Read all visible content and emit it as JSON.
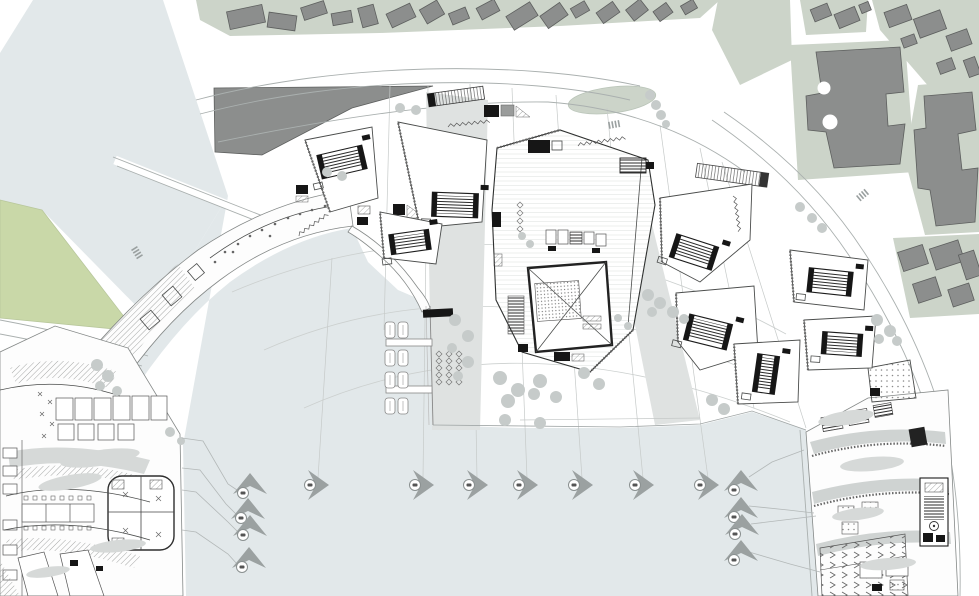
{
  "meta": {
    "drawing_type": "architectural-masterplan-site-plan",
    "canvas": {
      "w": 979,
      "h": 596
    }
  },
  "palette": {
    "water": "#e2e8ea",
    "park": "#c9d8a8",
    "block_green": "#ccd4c9",
    "bldg_gray": "#8c8e8d",
    "bldg_stroke": "#5d5f5e",
    "line": "#aab0af",
    "band": "#cfd3d2",
    "wash": "#dfe2e1",
    "tree": "#c6cbca",
    "dark": "#161616",
    "marker": "#9ba1a1"
  },
  "plan": {
    "markers": {
      "up": [
        {
          "x": 250,
          "y": 484
        },
        {
          "x": 248,
          "y": 509
        },
        {
          "x": 250,
          "y": 526
        },
        {
          "x": 249,
          "y": 558
        },
        {
          "x": 741,
          "y": 481
        },
        {
          "x": 741,
          "y": 508
        },
        {
          "x": 742,
          "y": 525
        },
        {
          "x": 741,
          "y": 551
        }
      ],
      "right": [
        {
          "x": 318,
          "y": 485
        },
        {
          "x": 423,
          "y": 485
        },
        {
          "x": 477,
          "y": 485
        },
        {
          "x": 527,
          "y": 485
        },
        {
          "x": 582,
          "y": 485
        },
        {
          "x": 643,
          "y": 485
        },
        {
          "x": 708,
          "y": 485
        }
      ]
    },
    "leader_lines": [
      [
        [
          182,
          438
        ],
        [
          203,
          441
        ],
        [
          228,
          484
        ],
        [
          237,
          490
        ]
      ],
      [
        [
          182,
          468
        ],
        [
          200,
          470
        ],
        [
          226,
          504
        ],
        [
          236,
          514
        ]
      ],
      [
        [
          182,
          490
        ],
        [
          196,
          492
        ],
        [
          228,
          522
        ],
        [
          238,
          532
        ]
      ],
      [
        [
          182,
          530
        ],
        [
          196,
          532
        ],
        [
          228,
          554
        ],
        [
          237,
          564
        ]
      ],
      [
        [
          749,
          477
        ],
        [
          772,
          462
        ],
        [
          804,
          450
        ]
      ],
      [
        [
          749,
          506
        ],
        [
          788,
          510
        ],
        [
          814,
          513
        ]
      ],
      [
        [
          751,
          524
        ],
        [
          792,
          519
        ],
        [
          816,
          516
        ]
      ],
      [
        [
          749,
          552
        ],
        [
          790,
          564
        ],
        [
          820,
          572
        ]
      ]
    ],
    "radial_lines": [
      [
        332,
        258,
        318,
        478
      ],
      [
        390,
        86,
        384,
        330
      ],
      [
        428,
        86,
        423,
        478
      ],
      [
        470,
        84,
        477,
        478
      ],
      [
        512,
        88,
        527,
        478
      ],
      [
        556,
        95,
        582,
        478
      ],
      [
        607,
        108,
        643,
        478
      ],
      [
        660,
        125,
        708,
        478
      ],
      [
        700,
        148,
        754,
        408
      ],
      [
        722,
        162,
        806,
        428
      ]
    ],
    "contour_curves": [
      "M 232,292 Q 500,178 786,334",
      "M 264,350 Q 505,244 796,394",
      "M 304,408 Q 520,312 790,422"
    ],
    "trees": [
      [
        400,
        108,
        5
      ],
      [
        416,
        110,
        5
      ],
      [
        650,
        95,
        5
      ],
      [
        656,
        105,
        5
      ],
      [
        661,
        115,
        5
      ],
      [
        666,
        124,
        4
      ],
      [
        327,
        172,
        5
      ],
      [
        342,
        176,
        5
      ],
      [
        800,
        207,
        5
      ],
      [
        812,
        218,
        5
      ],
      [
        822,
        228,
        5
      ],
      [
        648,
        295,
        6
      ],
      [
        660,
        303,
        6
      ],
      [
        673,
        312,
        6
      ],
      [
        684,
        319,
        5
      ],
      [
        652,
        312,
        5
      ],
      [
        712,
        400,
        6
      ],
      [
        724,
        409,
        6
      ],
      [
        877,
        320,
        6
      ],
      [
        890,
        331,
        6
      ],
      [
        897,
        341,
        5
      ],
      [
        879,
        339,
        5
      ],
      [
        500,
        378,
        7
      ],
      [
        518,
        390,
        7
      ],
      [
        508,
        401,
        7
      ],
      [
        540,
        381,
        7
      ],
      [
        534,
        394,
        6
      ],
      [
        556,
        397,
        6
      ],
      [
        584,
        373,
        6
      ],
      [
        599,
        384,
        6
      ],
      [
        505,
        420,
        6
      ],
      [
        540,
        423,
        6
      ],
      [
        455,
        320,
        6
      ],
      [
        468,
        336,
        6
      ],
      [
        452,
        348,
        5
      ],
      [
        468,
        362,
        6
      ],
      [
        458,
        376,
        5
      ],
      [
        97,
        365,
        6
      ],
      [
        108,
        376,
        6
      ],
      [
        100,
        386,
        5
      ],
      [
        117,
        391,
        5
      ],
      [
        170,
        432,
        5
      ],
      [
        181,
        441,
        4
      ],
      [
        522,
        236,
        4
      ],
      [
        530,
        244,
        4
      ],
      [
        618,
        318,
        4
      ],
      [
        628,
        326,
        4
      ]
    ],
    "veg_blobs": [
      [
        100,
        458,
        40,
        8,
        -8
      ],
      [
        70,
        482,
        32,
        7,
        -10
      ],
      [
        118,
        546,
        28,
        6,
        -6
      ],
      [
        48,
        572,
        22,
        5,
        -8
      ],
      [
        846,
        418,
        28,
        7,
        -9
      ],
      [
        872,
        464,
        32,
        7,
        -5
      ],
      [
        858,
        514,
        26,
        6,
        -7
      ],
      [
        888,
        564,
        28,
        6,
        -4
      ]
    ],
    "pavilions": [
      {
        "pts": "305,140 372,127 378,198 330,212",
        "core": [
          342,
          162,
          46,
          24,
          -13
        ]
      },
      {
        "pts": "398,122 487,140 482,222 420,228",
        "core": [
          455,
          205,
          46,
          24,
          2
        ]
      },
      {
        "pts": "380,212 442,224 436,264 384,258",
        "core": [
          410,
          242,
          40,
          20,
          -8
        ]
      },
      {
        "pts": "660,198 752,184 750,240 700,282 662,262",
        "core": [
          694,
          252,
          44,
          24,
          18
        ]
      },
      {
        "pts": "790,250 868,260 864,310 794,302",
        "core": [
          830,
          282,
          44,
          24,
          6
        ]
      },
      {
        "pts": "676,293 754,286 758,352 700,370 678,342",
        "core": [
          708,
          332,
          44,
          26,
          14
        ]
      },
      {
        "pts": "804,320 876,316 872,368 808,370",
        "core": [
          842,
          344,
          40,
          22,
          4
        ]
      },
      {
        "pts": "734,344 800,340 798,402 738,404",
        "core": [
          766,
          374,
          22,
          38,
          8
        ]
      }
    ],
    "city_buildings": [
      [
        228,
        8,
        36,
        18,
        -12
      ],
      [
        268,
        14,
        28,
        15,
        8
      ],
      [
        302,
        4,
        24,
        13,
        -18
      ],
      [
        332,
        12,
        20,
        12,
        -10
      ],
      [
        360,
        6,
        16,
        20,
        -15
      ],
      [
        388,
        8,
        26,
        15,
        -25
      ],
      [
        422,
        4,
        20,
        16,
        -30
      ],
      [
        450,
        10,
        18,
        12,
        -22
      ],
      [
        478,
        3,
        20,
        13,
        -28
      ],
      [
        508,
        8,
        28,
        16,
        -32
      ],
      [
        542,
        8,
        24,
        15,
        -35
      ],
      [
        572,
        4,
        16,
        11,
        -30
      ],
      [
        598,
        6,
        20,
        13,
        -35
      ],
      [
        628,
        3,
        18,
        14,
        -38
      ],
      [
        655,
        6,
        16,
        12,
        -36
      ],
      [
        682,
        2,
        14,
        10,
        -30
      ],
      [
        812,
        6,
        18,
        13,
        -22
      ],
      [
        836,
        10,
        22,
        15,
        -22
      ],
      [
        860,
        3,
        10,
        9,
        -22
      ],
      [
        886,
        8,
        24,
        16,
        -20
      ],
      [
        916,
        14,
        28,
        20,
        -20
      ],
      [
        948,
        32,
        22,
        16,
        -20
      ],
      [
        966,
        58,
        12,
        18,
        -20
      ],
      [
        938,
        60,
        16,
        12,
        -20
      ],
      [
        902,
        36,
        14,
        10,
        -20
      ],
      [
        900,
        248,
        26,
        20,
        -18
      ],
      [
        932,
        244,
        30,
        22,
        -18
      ],
      [
        962,
        252,
        16,
        26,
        -18
      ],
      [
        915,
        280,
        24,
        20,
        -18
      ],
      [
        950,
        286,
        22,
        18,
        -18
      ]
    ],
    "boats": [
      [
        390,
        322
      ],
      [
        403,
        322
      ],
      [
        390,
        350
      ],
      [
        403,
        350
      ],
      [
        390,
        372
      ],
      [
        403,
        372
      ],
      [
        390,
        398
      ],
      [
        403,
        398
      ]
    ],
    "plant_diamonds": {
      "x0": 439,
      "y0": 354,
      "cols": 3,
      "rows": 5,
      "dx": 10,
      "dy": 7
    },
    "squiggles": [
      [
        448,
        127,
        7,
        -6
      ],
      [
        578,
        146,
        8,
        -8
      ],
      [
        733,
        196,
        6,
        82
      ],
      [
        299,
        236,
        6,
        -35
      ]
    ],
    "crosswalks": [
      [
        137,
        246,
        58
      ],
      [
        608,
        122,
        -10
      ],
      [
        856,
        196,
        -40
      ]
    ]
  }
}
